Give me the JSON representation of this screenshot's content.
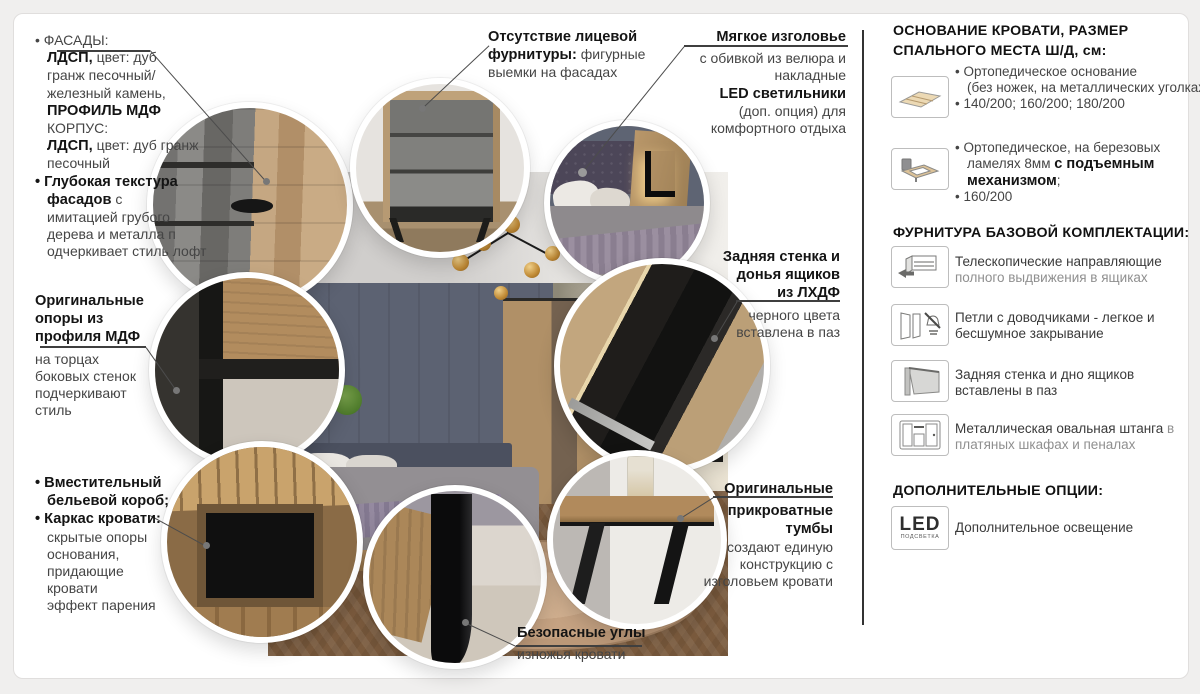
{
  "callouts": {
    "facades": {
      "lines": [
        {
          "t": [
            [
              "r",
              "• ФАСАДЫ:"
            ]
          ]
        },
        {
          "ind": 1,
          "t": [
            [
              "b",
              "ЛДСП,"
            ],
            [
              "r",
              " цвет: дуб"
            ]
          ]
        },
        {
          "ind": 1,
          "t": [
            [
              "r",
              "гранж песочный/"
            ]
          ]
        },
        {
          "ind": 1,
          "t": [
            [
              "r",
              "железный камень,"
            ]
          ]
        },
        {
          "ind": 1,
          "t": [
            [
              "b",
              "ПРОФИЛЬ МДФ"
            ]
          ]
        },
        {
          "ind": 1,
          "t": [
            [
              "r",
              "КОРПУС:"
            ]
          ]
        },
        {
          "ind": 1,
          "t": [
            [
              "b",
              "ЛДСП,"
            ],
            [
              "r",
              " цвет: дуб гранж"
            ]
          ]
        },
        {
          "ind": 1,
          "t": [
            [
              "r",
              "песочный"
            ]
          ]
        },
        {
          "t": [
            [
              "b",
              "• Глубокая текстура"
            ]
          ]
        },
        {
          "ind": 1,
          "t": [
            [
              "b",
              "фасадов"
            ],
            [
              "r",
              " с"
            ]
          ]
        },
        {
          "ind": 1,
          "t": [
            [
              "r",
              "имитацией грубого"
            ]
          ]
        },
        {
          "ind": 1,
          "t": [
            [
              "r",
              "дерева и металла п"
            ]
          ]
        },
        {
          "ind": 1,
          "t": [
            [
              "r",
              "одчеркивает стиль лофт"
            ]
          ]
        }
      ]
    },
    "supports": {
      "lines": [
        {
          "t": [
            [
              "b",
              "Оригинальные"
            ]
          ]
        },
        {
          "t": [
            [
              "b",
              "опоры из"
            ]
          ]
        },
        {
          "t": [
            [
              "b",
              "профиля МДФ"
            ]
          ]
        },
        {
          "mt": 1,
          "t": [
            [
              "r",
              "на торцах"
            ]
          ]
        },
        {
          "t": [
            [
              "r",
              "боковых стенок"
            ]
          ]
        },
        {
          "t": [
            [
              "r",
              "подчеркивают"
            ]
          ]
        },
        {
          "t": [
            [
              "r",
              "стиль"
            ]
          ]
        }
      ]
    },
    "linen_box": {
      "lines": [
        {
          "t": [
            [
              "b",
              "• Вместительный"
            ]
          ]
        },
        {
          "ind": 1,
          "t": [
            [
              "b",
              "бельевой короб;"
            ]
          ]
        },
        {
          "t": [
            [
              "b",
              "• Каркас кровати:"
            ]
          ]
        },
        {
          "ind": 1,
          "t": [
            [
              "r",
              "скрытые опоры"
            ]
          ]
        },
        {
          "ind": 1,
          "t": [
            [
              "r",
              "основания,"
            ]
          ]
        },
        {
          "ind": 1,
          "t": [
            [
              "r",
              "придающие"
            ]
          ]
        },
        {
          "ind": 1,
          "t": [
            [
              "r",
              "кровати"
            ]
          ]
        },
        {
          "ind": 1,
          "t": [
            [
              "r",
              "эффект парения"
            ]
          ]
        }
      ]
    },
    "no_hardware": {
      "lines": [
        {
          "t": [
            [
              "b",
              "Отсутствие лицевой"
            ]
          ]
        },
        {
          "t": [
            [
              "b",
              "фурнитуры:"
            ],
            [
              "r",
              " фигурные"
            ]
          ]
        },
        {
          "t": [
            [
              "r",
              "выемки на фасадах"
            ]
          ]
        }
      ]
    },
    "headboard": {
      "lines": [
        {
          "t": [
            [
              "b",
              "Мягкое изголовье"
            ]
          ]
        },
        {
          "mt": 1,
          "t": [
            [
              "r",
              "с обивкой из велюра и"
            ]
          ]
        },
        {
          "t": [
            [
              "r",
              "накладные"
            ]
          ]
        },
        {
          "t": [
            [
              "b",
              "LED светильники"
            ]
          ]
        },
        {
          "t": [
            [
              "r",
              "(доп. опция) для"
            ]
          ]
        },
        {
          "t": [
            [
              "r",
              "комфортного отдыха"
            ]
          ]
        }
      ]
    },
    "back_wall": {
      "lines": [
        {
          "t": [
            [
              "b",
              "Задняя стенка и"
            ]
          ]
        },
        {
          "t": [
            [
              "b",
              "донья ящиков"
            ]
          ]
        },
        {
          "t": [
            [
              "b",
              "из ЛХДФ"
            ]
          ]
        },
        {
          "mt": 1,
          "t": [
            [
              "r",
              "черного цвета"
            ]
          ]
        },
        {
          "t": [
            [
              "r",
              "вставлена в паз"
            ]
          ]
        }
      ]
    },
    "bedside": {
      "lines": [
        {
          "t": [
            [
              "b",
              "Оригинальные"
            ]
          ]
        },
        {
          "mt": 1,
          "t": [
            [
              "b",
              "прикроватные"
            ]
          ]
        },
        {
          "t": [
            [
              "b",
              "тумбы"
            ]
          ]
        },
        {
          "t": [
            [
              "r",
              "создают единую"
            ]
          ]
        },
        {
          "t": [
            [
              "r",
              "конструкцию с"
            ]
          ]
        },
        {
          "t": [
            [
              "r",
              "изголовьем кровати"
            ]
          ]
        }
      ]
    },
    "safe_corners": {
      "lines": [
        {
          "t": [
            [
              "b",
              "Безопасные углы"
            ]
          ]
        },
        {
          "mt": 1,
          "t": [
            [
              "r",
              "изножья кровати"
            ]
          ]
        }
      ]
    }
  },
  "panel": {
    "heading_base_1": "ОСНОВАНИЕ КРОВАТИ, РАЗМЕР",
    "heading_base_2": "СПАЛЬНОГО МЕСТА Ш/Д, см:",
    "heading_hardware": "ФУРНИТУРА БАЗОВОЙ КОМПЛЕКТАЦИИ:",
    "heading_options": "ДОПОЛНИТЕЛЬНЫЕ ОПЦИИ:",
    "rows": [
      {
        "icon": "slat-base-icon",
        "lines": [
          {
            "t": [
              [
                "r",
                "• Ортопедическое основание"
              ]
            ]
          },
          {
            "ind": 1,
            "t": [
              [
                "r",
                "(без ножек, на металлических уголках)"
              ]
            ]
          },
          {
            "t": [
              [
                "r",
                "• 140/200; 160/200; 180/200"
              ]
            ]
          }
        ]
      },
      {
        "icon": "lift-bed-icon",
        "lines": [
          {
            "t": [
              [
                "r",
                "• Ортопедическое, на березовых"
              ]
            ]
          },
          {
            "ind": 1,
            "t": [
              [
                "r",
                "ламелях 8мм "
              ],
              [
                "b",
                "с подъемным"
              ]
            ]
          },
          {
            "ind": 1,
            "t": [
              [
                "b",
                "механизмом"
              ],
              [
                "r",
                ";"
              ]
            ]
          },
          {
            "t": [
              [
                "r",
                "• 160/200"
              ]
            ]
          }
        ]
      },
      {
        "icon": "drawer-slides-icon",
        "lines": [
          {
            "t": [
              [
                "d",
                "Телескопические направляющие"
              ]
            ]
          },
          {
            "t": [
              [
                "g",
                "полного выдвижения в ящиках"
              ]
            ]
          }
        ]
      },
      {
        "icon": "door-hinge-silent-icon",
        "lines": [
          {
            "t": [
              [
                "d",
                "Петли с доводчиками - легкое и"
              ]
            ]
          },
          {
            "t": [
              [
                "d",
                "бесшумное закрывание"
              ]
            ]
          }
        ]
      },
      {
        "icon": "panel-groove-icon",
        "lines": [
          {
            "t": [
              [
                "d",
                "Задняя стенка и дно ящиков"
              ]
            ]
          },
          {
            "t": [
              [
                "d",
                "вставлены в паз"
              ]
            ]
          }
        ]
      },
      {
        "icon": "wardrobe-rod-icon",
        "lines": [
          {
            "t": [
              [
                "d",
                "Металлическая овальная штанга"
              ],
              [
                "g",
                " в"
              ]
            ]
          },
          {
            "t": [
              [
                "g",
                "платяных шкафах и пеналах"
              ]
            ]
          }
        ]
      },
      {
        "icon": "led-backlight-icon",
        "lines": [
          {
            "t": [
              [
                "d",
                "Дополнительное освещение"
              ]
            ]
          }
        ]
      }
    ],
    "led": {
      "big": "LED",
      "small": "ПОДСВЕТКА"
    }
  },
  "colors": {
    "text_dark": "#141414",
    "text_gray": "#454545",
    "text_light": "#8f8f8f",
    "divider": "#333333",
    "wall_blue": "#5c6272",
    "wood_tan": "#b09067"
  }
}
